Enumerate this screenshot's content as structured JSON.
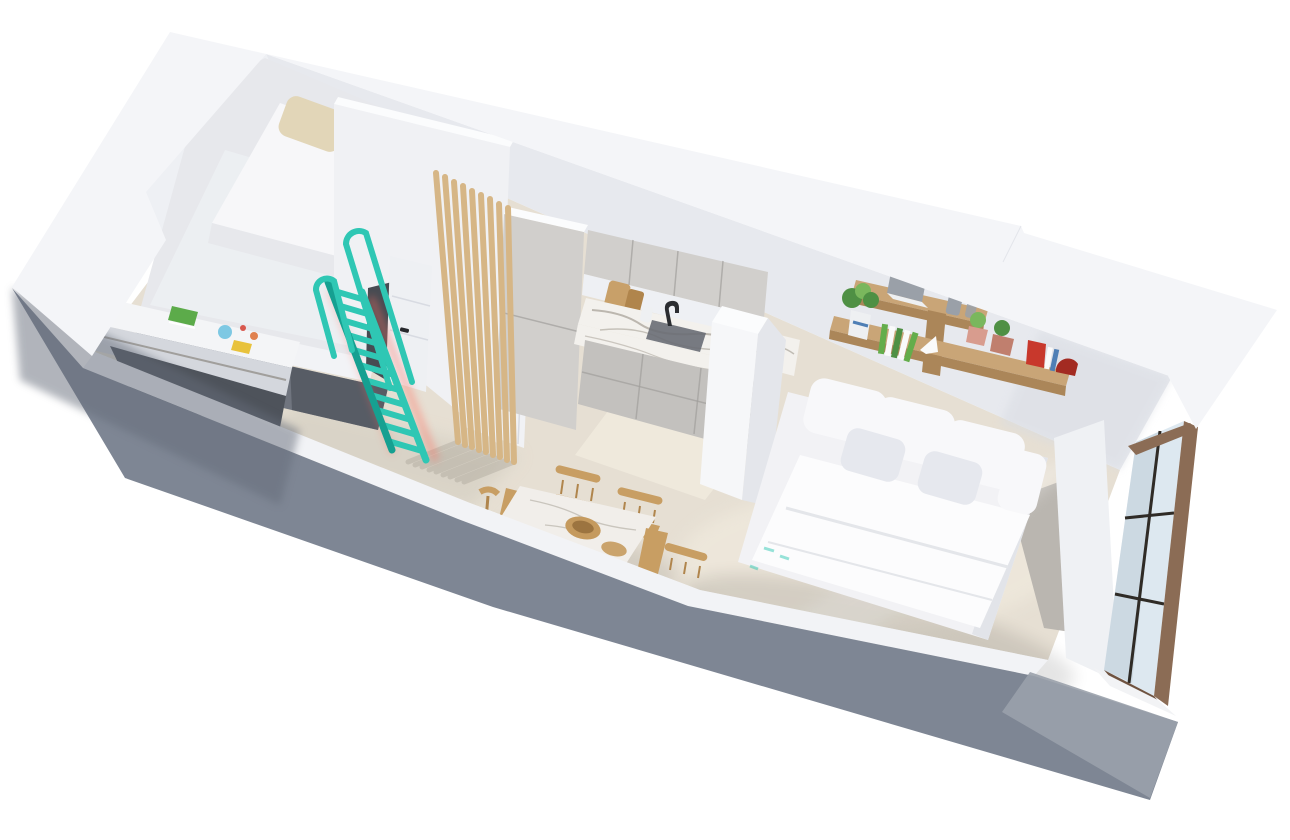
{
  "canvas": {
    "width": 1290,
    "height": 840
  },
  "scene": {
    "type": "3d-isometric-floorplan-render",
    "description": "Aerial cutaway 3D render of a small studio apartment with loft bed, kitchen, dining area and bedroom",
    "rooms": [
      {
        "label": "loft-sleeping-area",
        "furniture": [
          "loft mattress",
          "two beige pillows",
          "teal safety rails",
          "teal ladder",
          "built-in desk",
          "green book",
          "toys"
        ]
      },
      {
        "label": "hallway",
        "furniture": [
          "white entry door",
          "wooden slat partition",
          "white wardrobe panel"
        ]
      },
      {
        "label": "kitchen",
        "furniture": [
          "tall cabinet",
          "upper cabinets",
          "marble countertop",
          "sink",
          "black faucet",
          "cutting boards",
          "base cabinets",
          "white half wall"
        ]
      },
      {
        "label": "dining-area",
        "furniture": [
          "marble dining table",
          "wooden bowl",
          "four wooden chairs"
        ]
      },
      {
        "label": "bedroom",
        "furniture": [
          "double bed",
          "six white pillows",
          "two wooden wall shelves",
          "laptop",
          "plants",
          "books",
          "red bookend",
          "large bronze-framed window"
        ]
      }
    ]
  },
  "colors": {
    "page_bg": "#ffffff",
    "wall_top": "#f4f5f8",
    "wall_top_bright": "#fbfcfd",
    "wall_face": "#e7e9ee",
    "wall_face_light": "#eef0f4",
    "wall_face_shadow": "#d8dbe2",
    "partition_face": "#f0f1f4",
    "strip_white": "#f2f3f6",
    "floor": "#e6dfd3",
    "floor_light": "#f2ecdf",
    "floor_dark": "#d7d1c5",
    "floor_gray": "#b7b3ae",
    "exterior_gray": "#7e8694",
    "exterior_gray_dark": "#656c79",
    "exterior_gray_light": "#9aa1ab",
    "under_loft": "#70757f",
    "under_loft_dark": "#51565f",
    "desk_top": "#f4f5f7",
    "desk_front": "#d4d7dd",
    "desk_dark": "#4e535b",
    "mattress": "#f7f7f9",
    "mattress_side": "#e7e8ec",
    "pillow_beige": "#e2d6b8",
    "pillow_beige_dark": "#d0c3a0",
    "teal": "#2fc7b4",
    "teal_dark": "#16a091",
    "coral": "#ff6f61",
    "door_white": "#eef0f3",
    "door_gap": "#474b52",
    "door_handle": "#26282c",
    "wardrobe": "#f1f2f5",
    "slat": "#d6b686",
    "slat_shadow": "#7a7468",
    "cabinet": "#d1cfcc",
    "cabinet_dark": "#c3c1be",
    "cabinet_seam": "#a19f9c",
    "counter_marble": "#f3f1ed",
    "marble_vein": "#8e877b",
    "sink": "#696d74",
    "faucet": "#2b2d31",
    "board_wood": "#c8a069",
    "halfwall": "#f6f7f9",
    "halfwall_side": "#e4e6eb",
    "shelf_wood": "#c9a577",
    "shelf_wood_dark": "#ab8659",
    "plant_green": "#4f9044",
    "plant_green_light": "#7ab75d",
    "pot_pink": "#d89c8e",
    "pot_pink_dark": "#c07f6e",
    "vase_gray": "#9aa0a8",
    "vase_white": "#eef0f2",
    "book_green": "#64ad4b",
    "book_white": "#fafafa",
    "book_blue": "#4f7fb5",
    "red": "#c8382c",
    "red_dark": "#a32b22",
    "bed_white": "#f2f2f5",
    "bed_side": "#e2e4e9",
    "duvet": "#fcfcfd",
    "duvet_fold": "#e4e6ea",
    "pillow_white": "#f8f8fa",
    "pillow_white_shade": "#e6e8ee",
    "table_top": "#f1eeea",
    "table_edge": "#dbd6cf",
    "chair_wood": "#c89e63",
    "chair_wood_dark": "#b0854c",
    "bowl_wood": "#c59a5e",
    "bowl_wood_dark": "#9c7440",
    "window_bronze": "#8b6c55",
    "window_bronze_dark": "#6f5340",
    "window_glass": "#dde8f0",
    "window_glass_dark": "#c2cfd9",
    "mullion": "#2f2b26",
    "pier_white": "#eff1f4",
    "sill_white": "#f2f3f5",
    "toy_blue": "#7ec8e3",
    "toy_yellow": "#e8c23c",
    "toy_orange": "#e0814f",
    "toy_red": "#d8574d",
    "desk_book_green": "#5cab4a"
  }
}
